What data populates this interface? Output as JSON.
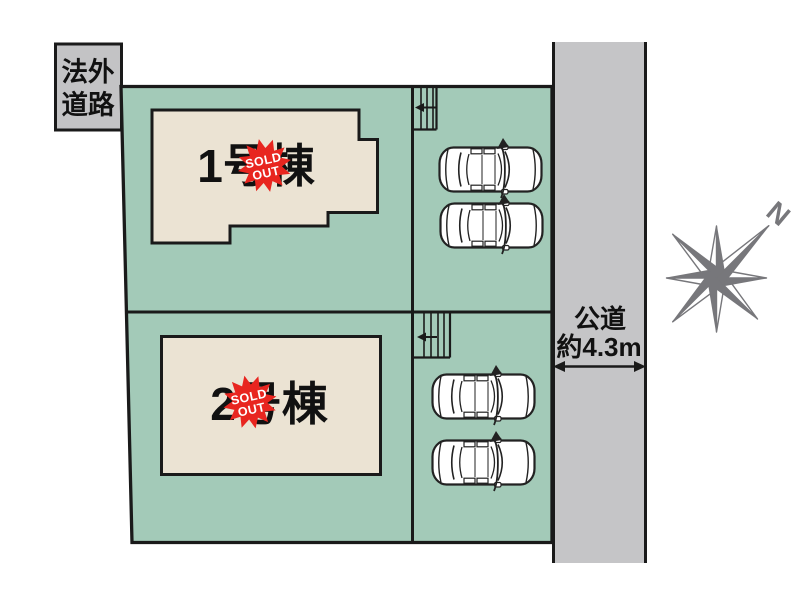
{
  "diagram": {
    "lot1": {
      "label": "1号棟"
    },
    "lot2": {
      "label": "2号棟"
    },
    "sold_badge": {
      "line1": "SOLD",
      "line2": "OUT"
    },
    "offplan_road": {
      "line1": "法外",
      "line2": "道路"
    },
    "public_road": {
      "line1": "公道",
      "line2": "約4.3m"
    },
    "compass": {
      "north_label": "N"
    }
  },
  "colors": {
    "plot_green": "#a3cab8",
    "building_beige": "#ebe3d3",
    "road_gray": "#c5c5c7",
    "badge_red": "#e8251f",
    "compass_gray": "#77777b",
    "outline_black": "#1a1a1a"
  }
}
